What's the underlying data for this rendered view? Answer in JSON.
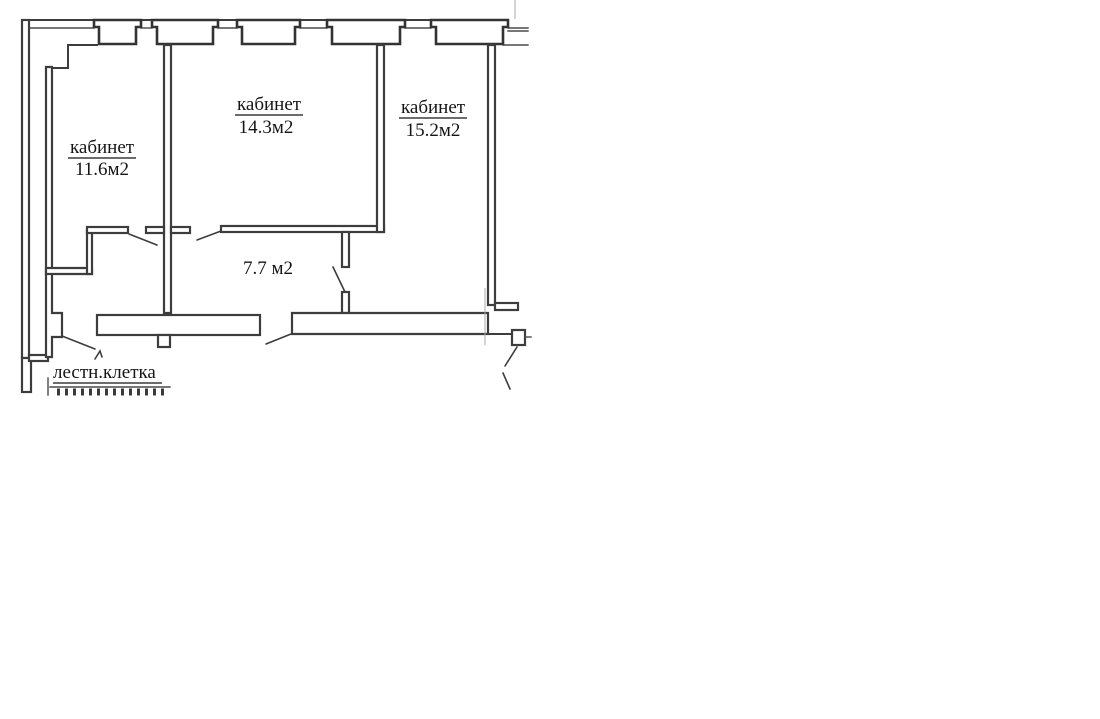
{
  "plan": {
    "rooms": [
      {
        "name": "кабинет",
        "area": "11.6м2"
      },
      {
        "name": "кабинет",
        "area": "14.3м2"
      },
      {
        "name": "кабинет",
        "area": "15.2м2"
      }
    ],
    "corridor": {
      "area": "7.7 м2"
    },
    "staircase": {
      "label": "лестн.клетка"
    }
  },
  "colors": {
    "background": "#ffffff",
    "wall_line": "#3d3d3d",
    "text": "#151515"
  }
}
